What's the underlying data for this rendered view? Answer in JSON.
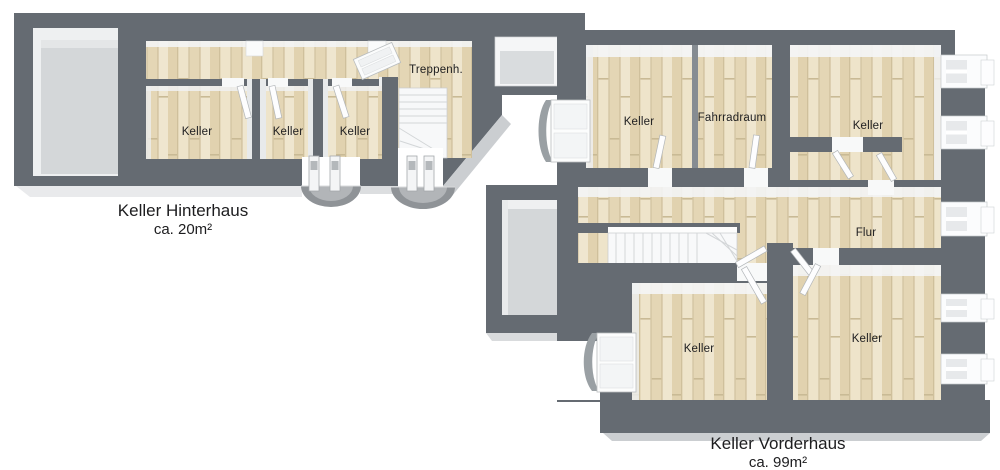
{
  "plan": {
    "title": "Keller floor plan",
    "hinterhaus": {
      "caption": {
        "line1": "Keller Hinterhaus",
        "line2": "ca. 20m²"
      },
      "rooms": [
        {
          "label": "Keller"
        },
        {
          "label": "Keller"
        },
        {
          "label": "Keller"
        },
        {
          "label": "Treppenh."
        }
      ]
    },
    "vorderhaus": {
      "caption": {
        "line1": "Keller Vorderhaus",
        "line2": "ca. 99m²"
      },
      "rooms": [
        {
          "label": "Keller"
        },
        {
          "label": "Fahrradraum"
        },
        {
          "label": "Keller"
        },
        {
          "label": "Flur"
        },
        {
          "label": "Keller"
        },
        {
          "label": "Keller"
        }
      ]
    },
    "colors": {
      "wall": "#656b72",
      "wood_floor": "#e8dcc1",
      "concrete_floor": "#d4d7d9",
      "edge_skirt": "#cbced1",
      "background": "#ffffff"
    }
  }
}
